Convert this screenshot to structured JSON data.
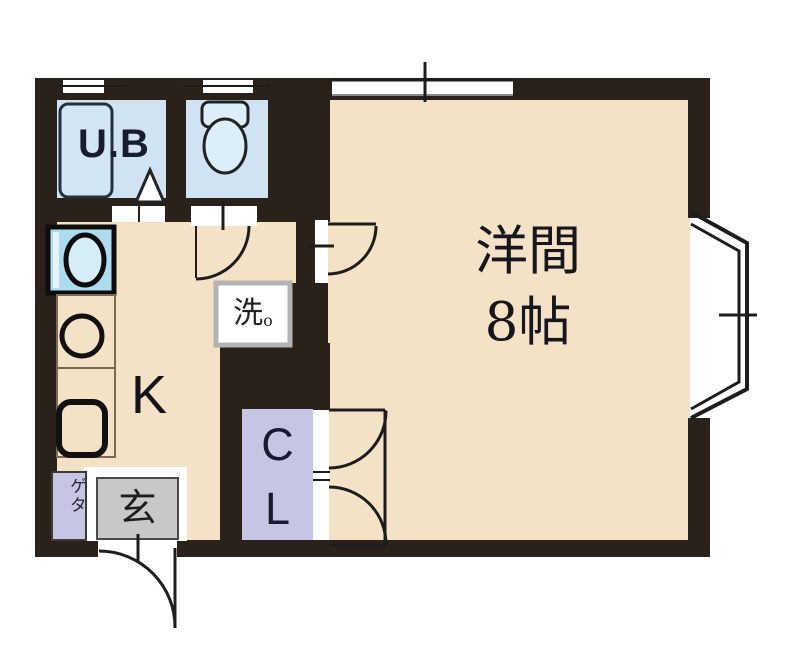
{
  "floor_plan": {
    "western_room": {
      "name": "洋間",
      "size": "8帖"
    },
    "kitchen_label": "K",
    "unit_bath_label": "U.B",
    "closet": {
      "top": "C",
      "bottom": "L"
    },
    "entrance_label": "玄",
    "shoe_cabinet_label": "ゲタ",
    "washer_label": "洗",
    "washer_sub": "o",
    "colors": {
      "wall": "#2b211b",
      "floor": "#f3e2c6",
      "wet_area": "#cfe3f2",
      "closet_purple": "#c6c5e4",
      "entrance_gray": "#c8c8c8",
      "opening_white": "#ffffff"
    }
  }
}
